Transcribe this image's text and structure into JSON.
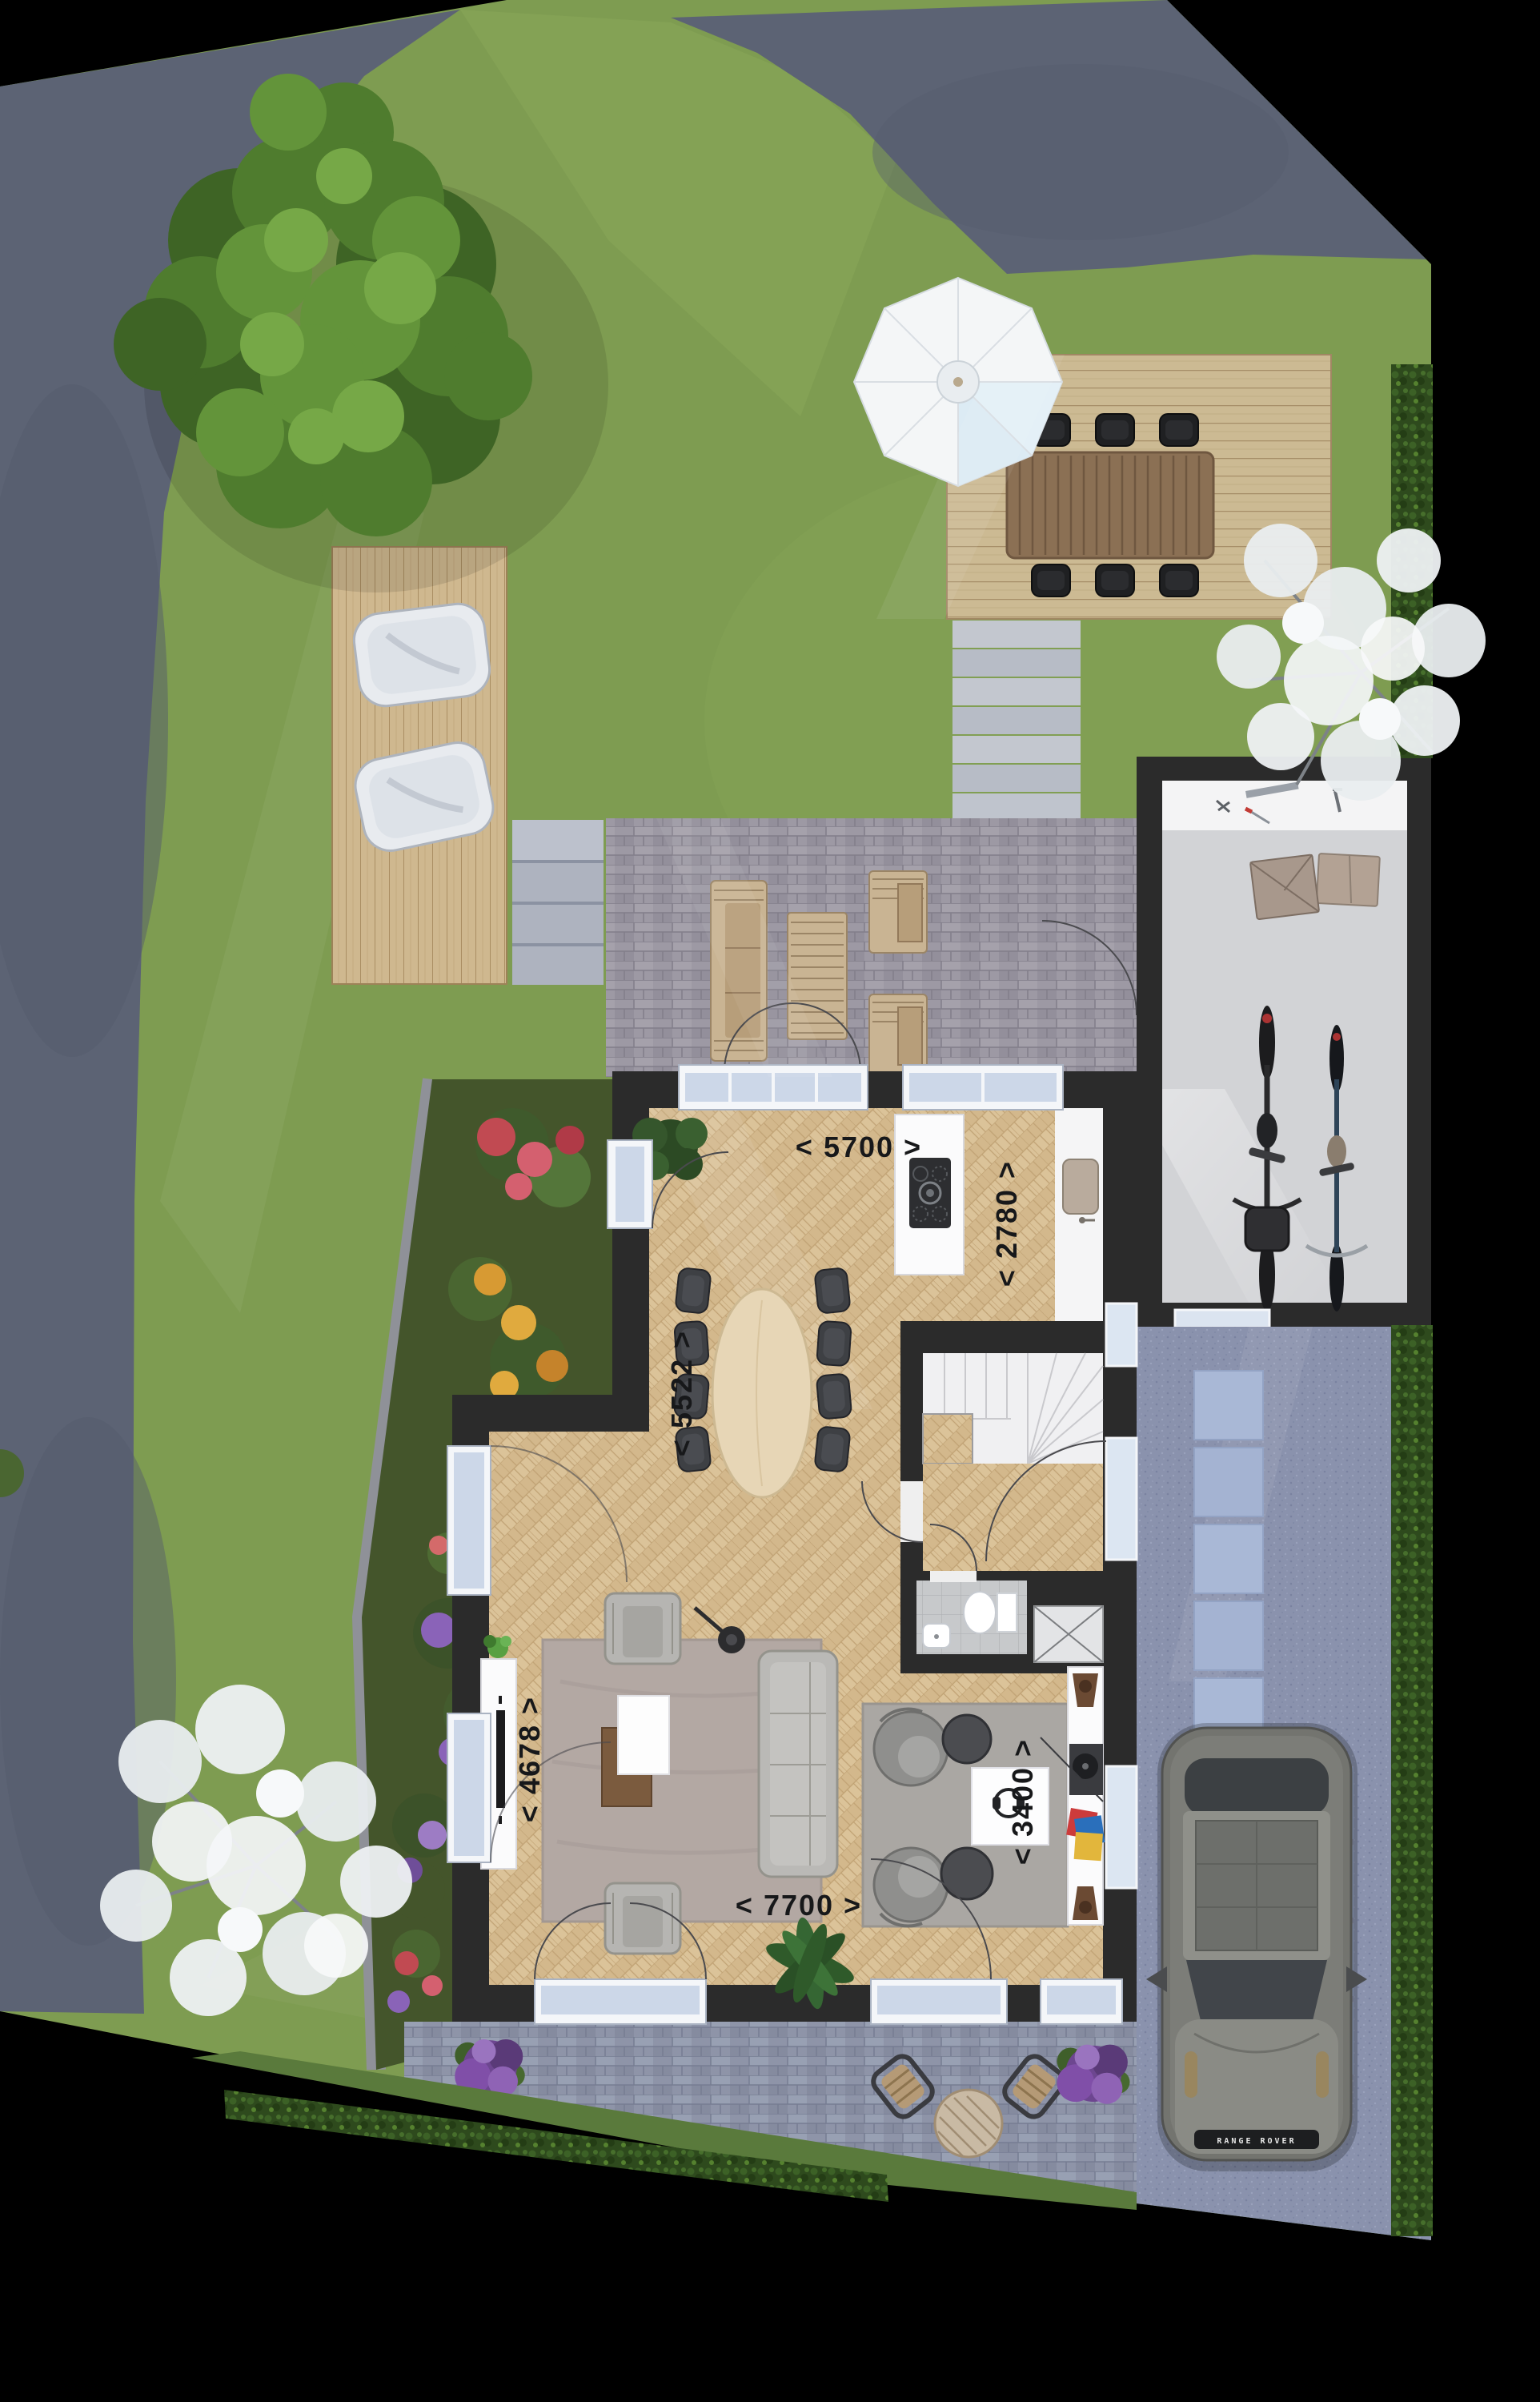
{
  "plan": {
    "type": "residential-site-and-floor-plan",
    "dimension_labels": {
      "kitchen_width": "< 5700 >",
      "kitchen_depth": "< 2780 >",
      "dining_depth": "< 5522 >",
      "living_width": "< 4678 >",
      "sitting_width": "< 3400 >",
      "living_length": "< 7700 >"
    },
    "car_badge": "RANGE ROVER",
    "palette": {
      "background": "#000000",
      "water": "#5c6374",
      "lawn": "#7e9c51",
      "deck_wood": "#cfb88f",
      "terrace_back": "#9d99a4",
      "terrace_front": "#8e94a8",
      "driveway": "#8a92ad",
      "stepping_tile": "#a9b8d6",
      "hedge": "#2e4a1d",
      "walls": "#2b2b2b",
      "parquet": "#d8bf94",
      "car_body": "#73746f",
      "umbrella": "#f4f6f7"
    },
    "features": [
      "waterfront garden",
      "large tree",
      "flower border",
      "lounge deck with sunbeds",
      "dining deck with parasol",
      "back terrace with wooden lounge set",
      "garage with workbench and bicycles",
      "driveway with stepping tiles",
      "parked car",
      "kitchen with island",
      "dining table for eight",
      "living room",
      "sitting corner",
      "staircase",
      "toilet",
      "front terrace with bistro set",
      "hedges",
      "blossom trees"
    ]
  }
}
